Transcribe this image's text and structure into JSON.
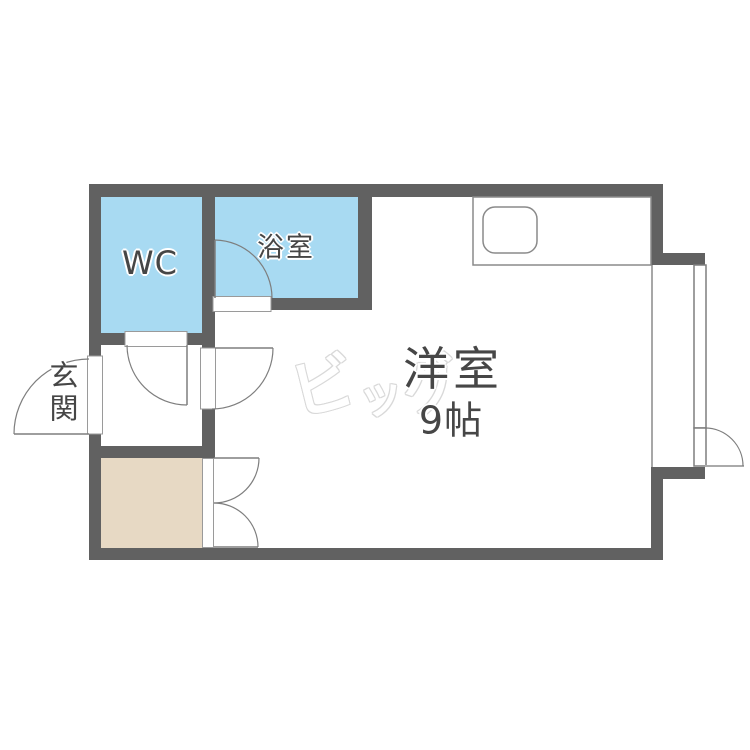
{
  "floorplan": {
    "rooms": {
      "wc": {
        "label": "WC"
      },
      "bathroom": {
        "label": "浴室"
      },
      "entrance": {
        "label": "玄関"
      },
      "main_room": {
        "name": "洋室",
        "size": "9帖"
      }
    },
    "watermark": {
      "text": "ビッグ",
      "chars": [
        "ビ",
        "ッ",
        "グ"
      ]
    },
    "colors": {
      "wall": "#616161",
      "wet_area": "#A8DAF2",
      "closet": "#E7D9C4",
      "outline": "#7e7e7e",
      "frame": "#9a9a9a",
      "label": "#464646",
      "watermark": "#d9d9d9"
    }
  }
}
